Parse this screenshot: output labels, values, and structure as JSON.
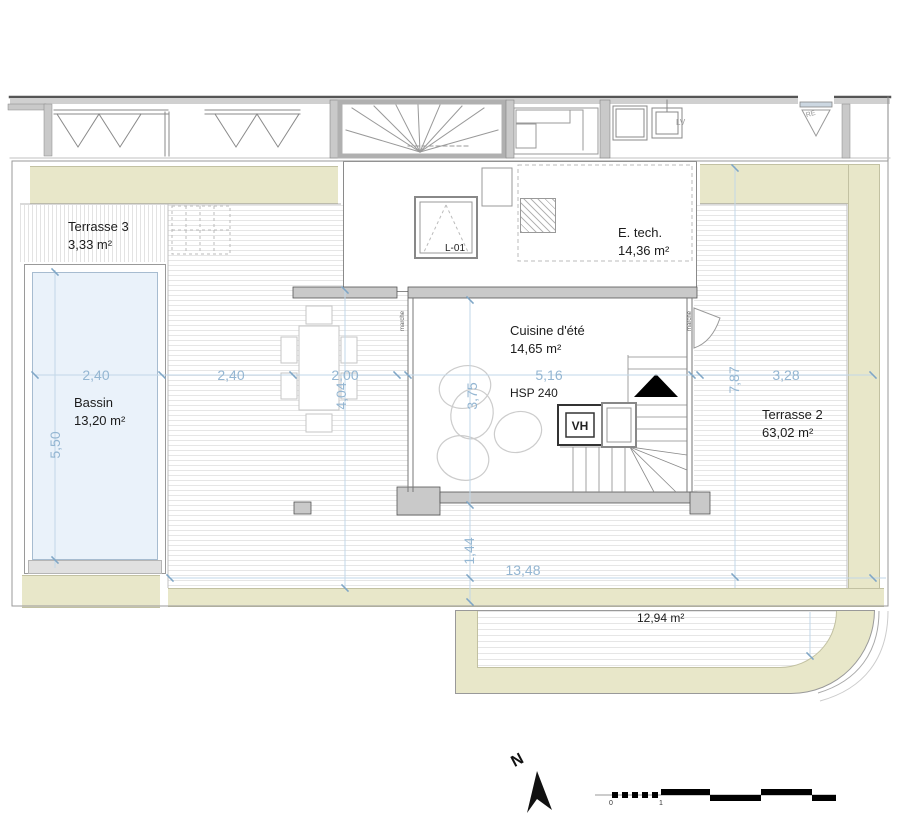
{
  "colors": {
    "beige_planter": "#e8e7c9",
    "pool_water": "#eaf2fa",
    "dimension_blue": "#94b6d2",
    "wall_gray": "#c9c9c9"
  },
  "rooms": {
    "terrasse3": {
      "name": "Terrasse 3",
      "area": "3,33 m²"
    },
    "bassin": {
      "name": "Bassin",
      "area": "13,20 m²"
    },
    "etech": {
      "name": "E. tech.",
      "area": "14,36 m²"
    },
    "cuisine": {
      "name": "Cuisine d'été",
      "area": "14,65 m²",
      "ceiling_height": "HSP 240"
    },
    "terrasse2": {
      "name": "Terrasse 2",
      "area": "63,02 m²"
    },
    "terrace_lower": {
      "area": "12,94 m²"
    }
  },
  "fixtures": {
    "skylight_label": "L-01",
    "roof_vent": "VH",
    "dishwasher": "LV",
    "door_tag": "RE",
    "step_left": "marche",
    "step_right": "marche"
  },
  "dimensions": {
    "pool_width": "2,40",
    "pool_length": "5,50",
    "deck_left": "2,40",
    "deck_mid": "2,00",
    "cuisine_width": "5,16",
    "cuisine_depth": "3,75",
    "table_zone": "4,04",
    "terrasse2_width": "3,28",
    "terrasse2_length": "7,87",
    "south_offset": "1,44",
    "total_width": "13,48"
  },
  "compass": {
    "label": "N"
  },
  "scale_bar": {
    "start": "0",
    "unit": "1"
  }
}
